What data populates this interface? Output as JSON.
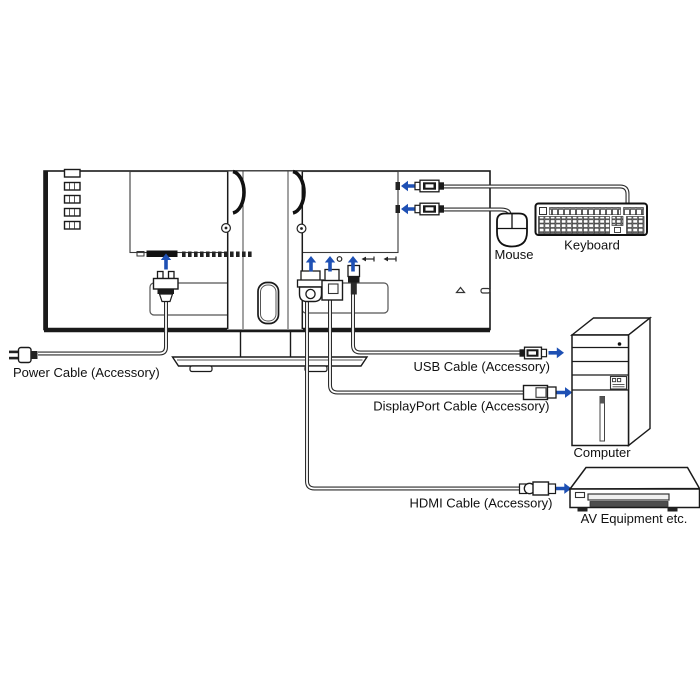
{
  "labels": {
    "power_cable": "Power Cable (Accessory)",
    "usb_cable": "USB Cable (Accessory)",
    "displayport_cable": "DisplayPort Cable (Accessory)",
    "hdmi_cable": "HDMI Cable (Accessory)",
    "mouse": "Mouse",
    "keyboard": "Keyboard",
    "computer": "Computer",
    "av_equipment": "AV Equipment etc."
  },
  "colors": {
    "arrow_accent_blue": "#1e50b4",
    "line_art": "#1a1a1a"
  }
}
